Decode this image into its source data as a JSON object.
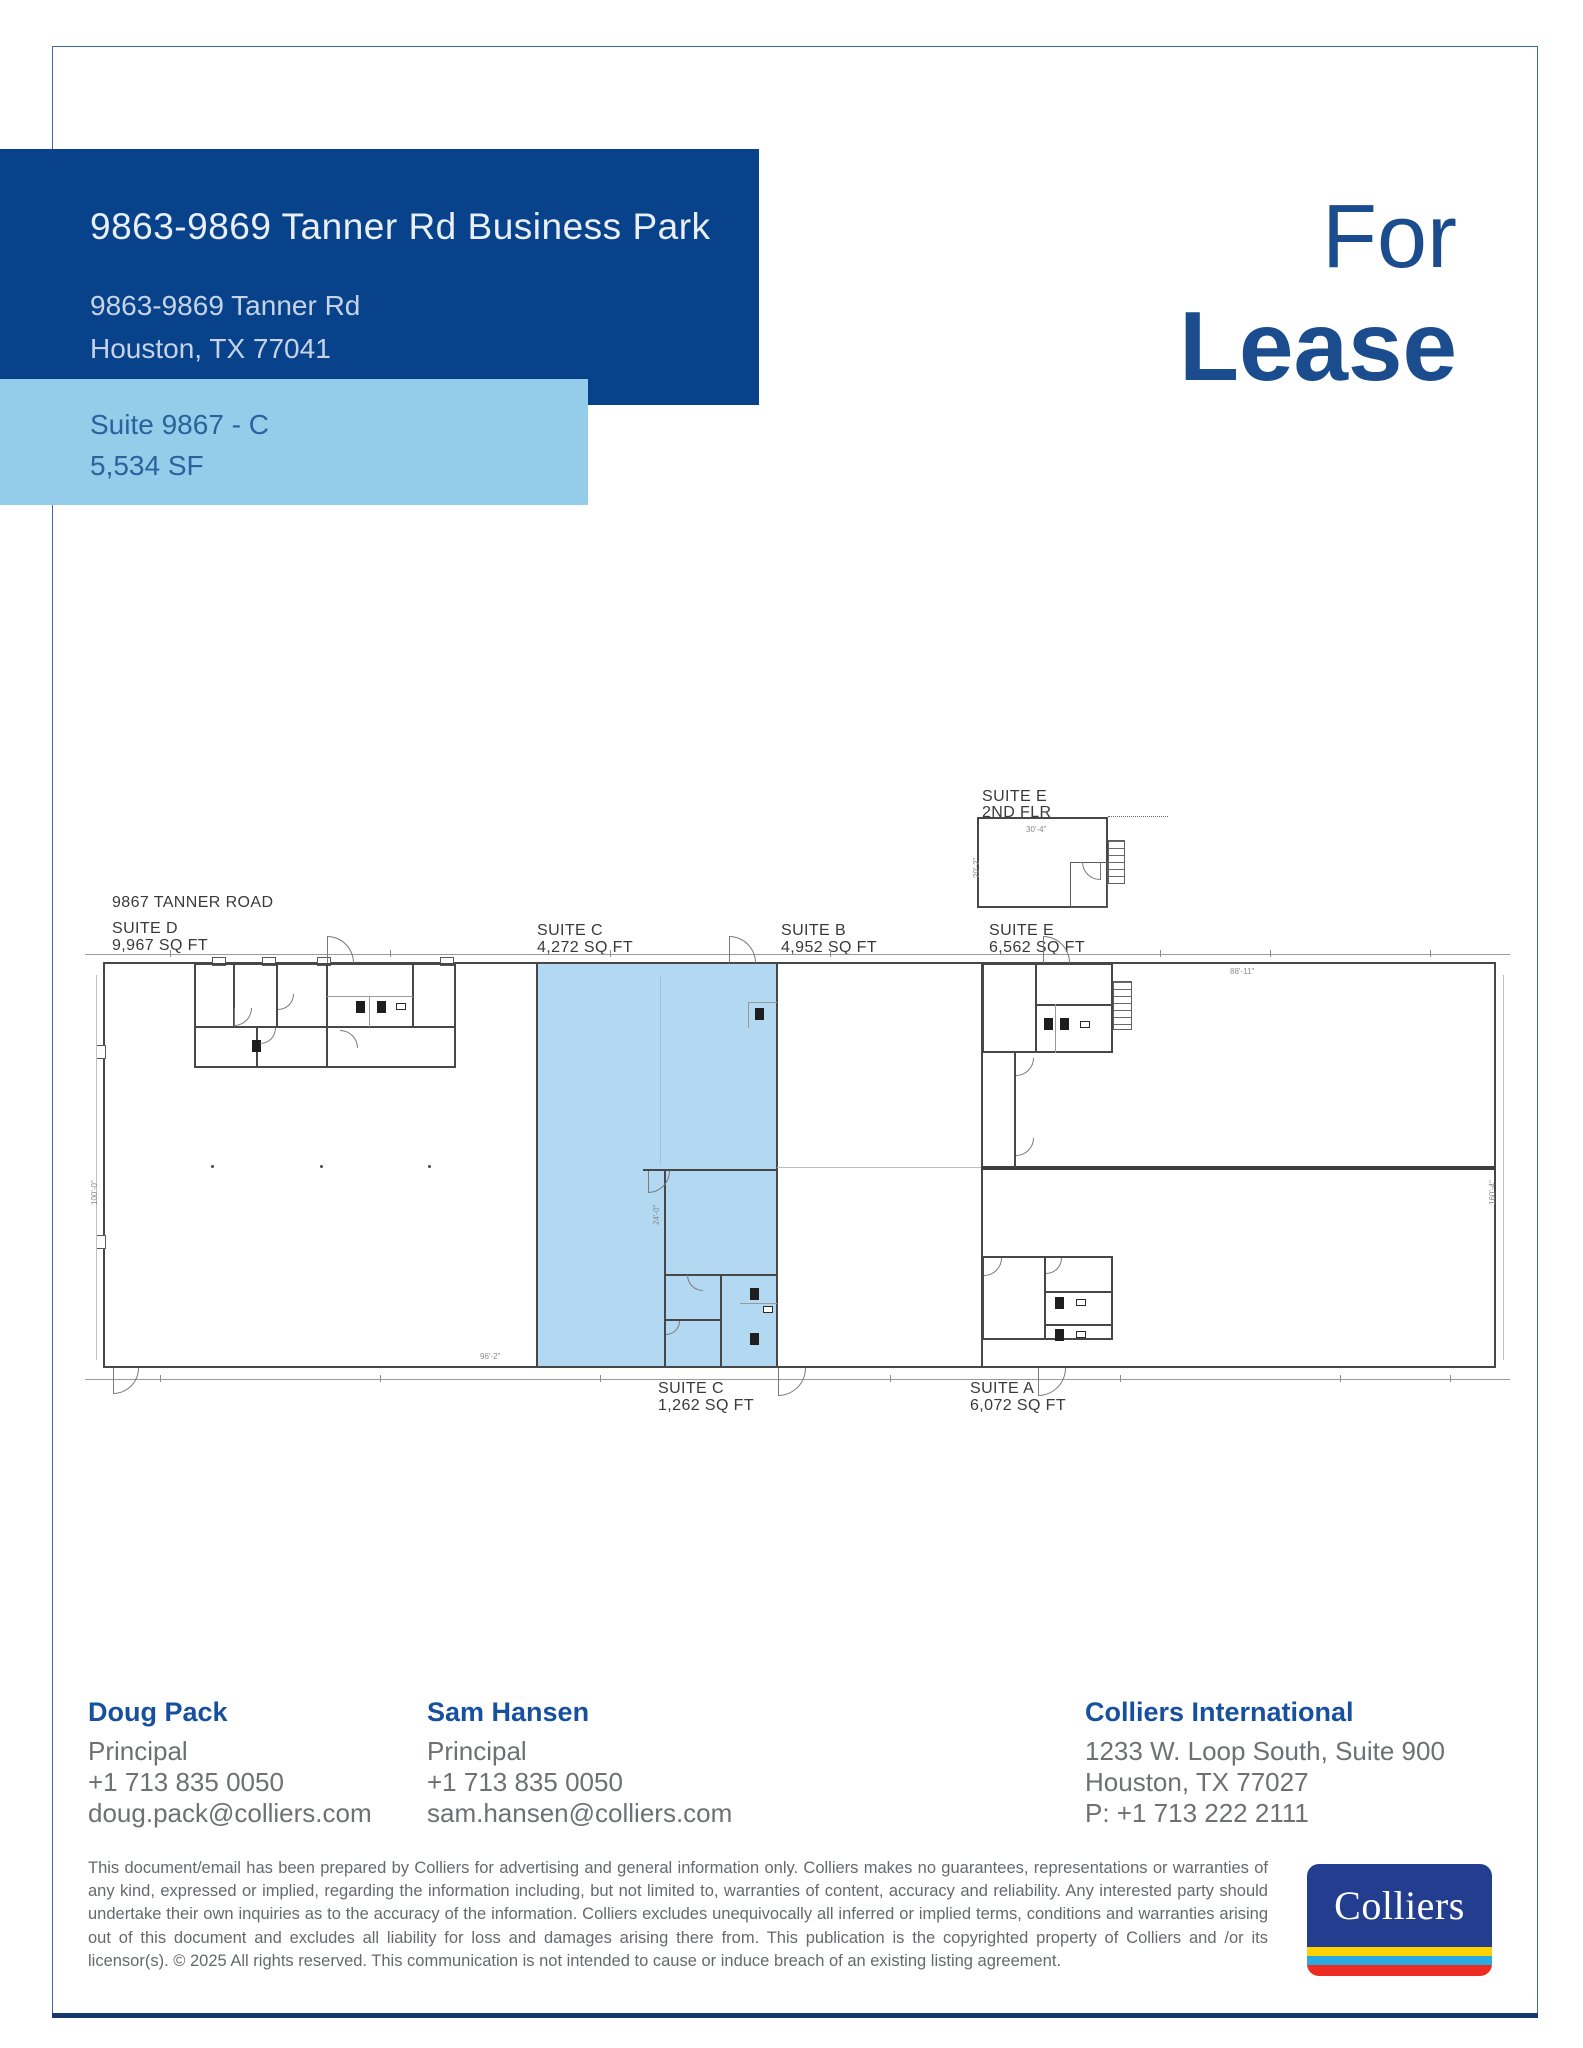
{
  "header": {
    "title": "9863-9869 Tanner Rd Business Park",
    "address_line1": "9863-9869 Tanner Rd",
    "address_line2": "Houston, TX 77041",
    "suite_line1": "Suite 9867 - C",
    "suite_line2": "5,534 SF",
    "lease_line1": "For",
    "lease_line2": "Lease"
  },
  "plan": {
    "road_label": "9867 TANNER ROAD",
    "suites": {
      "d": {
        "name": "SUITE D",
        "area": "9,967 SQ FT"
      },
      "c_top": {
        "name": "SUITE C",
        "area": "4,272 SQ FT"
      },
      "b": {
        "name": "SUITE B",
        "area": "4,952 SQ FT"
      },
      "e_top": {
        "name": "SUITE E",
        "area": "6,562 SQ FT"
      },
      "e_2nd": {
        "name": "SUITE E",
        "floor": "2ND FLR"
      },
      "c_bottom": {
        "name": "SUITE C",
        "area": "1,262 SQ FT"
      },
      "a": {
        "name": "SUITE A",
        "area": "6,072 SQ FT"
      }
    },
    "dims": {
      "d1": "88'-11\"",
      "d2": "160'-4\"",
      "d3": "100'-0\"",
      "d4": "96'-2\"",
      "d5": "24'-0\"",
      "d6": "30'-4\"",
      "d7": "20'-2\""
    }
  },
  "contacts": [
    {
      "name": "Doug Pack",
      "title": "Principal",
      "phone": "+1 713 835 0050",
      "email": "doug.pack@colliers.com"
    },
    {
      "name": "Sam Hansen",
      "title": "Principal",
      "phone": "+1 713 835 0050",
      "email": "sam.hansen@colliers.com"
    }
  ],
  "office": {
    "name": "Colliers International",
    "address1": "1233 W. Loop South, Suite 900",
    "address2": "Houston, TX 77027",
    "phone": "P: +1 713 222 2111"
  },
  "disclaimer": "This document/email has been prepared by Colliers for advertising and general information only. Colliers makes no guarantees, representations or warranties of any kind, expressed or implied, regarding the information including, but not limited to, warranties of content, accuracy and reliability. Any interested party should undertake their own inquiries as to the accuracy of the information. Colliers excludes unequivocally all inferred or implied terms, conditions and warranties arising out of this document and excludes all liability for loss and damages arising there from. This publication is the copyrighted property of Colliers and /or its licensor(s). © 2025 All rights reserved. This communication is not intended to cause or induce breach of an existing listing agreement.",
  "logo": {
    "text": "Colliers"
  },
  "colors": {
    "brand_blue": "#08428b",
    "light_blue": "#94cdea",
    "plan_highlight": "#b2d9f1",
    "lease_blue": "#1b4c8e",
    "name_blue": "#17509e",
    "logo_blue": "#233e8f",
    "stripe_yellow": "#ffd200",
    "stripe_cyan": "#29abe2",
    "stripe_red": "#ee2a24"
  }
}
